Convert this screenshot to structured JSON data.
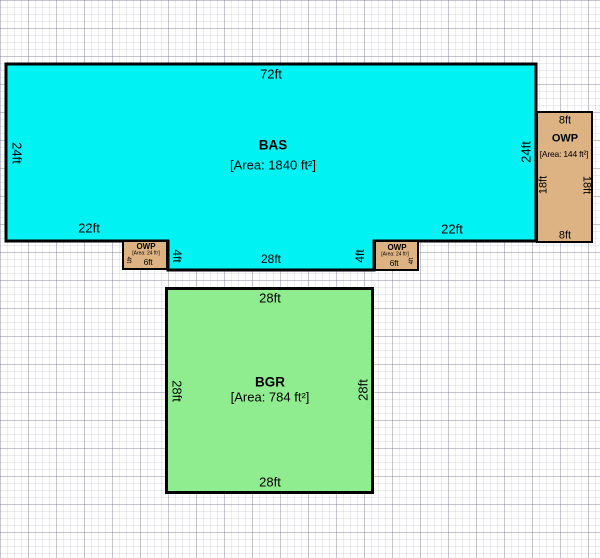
{
  "canvas": {
    "background": "#ffffff",
    "grid_minor_px": 7,
    "grid_major_px": 28
  },
  "rooms": {
    "bas": {
      "name": "BAS",
      "area": "[Area: 1840 ft²]",
      "fill": "#00F2F2",
      "dims": {
        "top": "72ft",
        "left": "24ft",
        "right": "24ft",
        "bottom_left": "22ft",
        "bottom_right": "22ft",
        "bottom_middle": "28ft",
        "step_left": "4ft",
        "step_right": "4ft"
      }
    },
    "owp_large": {
      "name": "OWP",
      "area": "[Area: 144 ft²]",
      "fill": "#DEB383",
      "dims": {
        "top": "8ft",
        "bottom": "8ft",
        "left": "18ft",
        "right": "18ft"
      }
    },
    "owp_small_left": {
      "name": "OWP",
      "area": "[Area: 24 ft²]",
      "fill": "#DEB383",
      "dims": {
        "bottom": "6ft",
        "side": "4ft"
      }
    },
    "owp_small_right": {
      "name": "OWP",
      "area": "[Area: 24 ft²]",
      "fill": "#DEB383",
      "dims": {
        "bottom": "6ft",
        "side": "4ft"
      }
    },
    "bgr": {
      "name": "BGR",
      "area": "[Area: 784 ft²]",
      "fill": "#8FED8F",
      "dims": {
        "top": "28ft",
        "bottom": "28ft",
        "left": "28ft",
        "right": "28ft"
      }
    }
  }
}
